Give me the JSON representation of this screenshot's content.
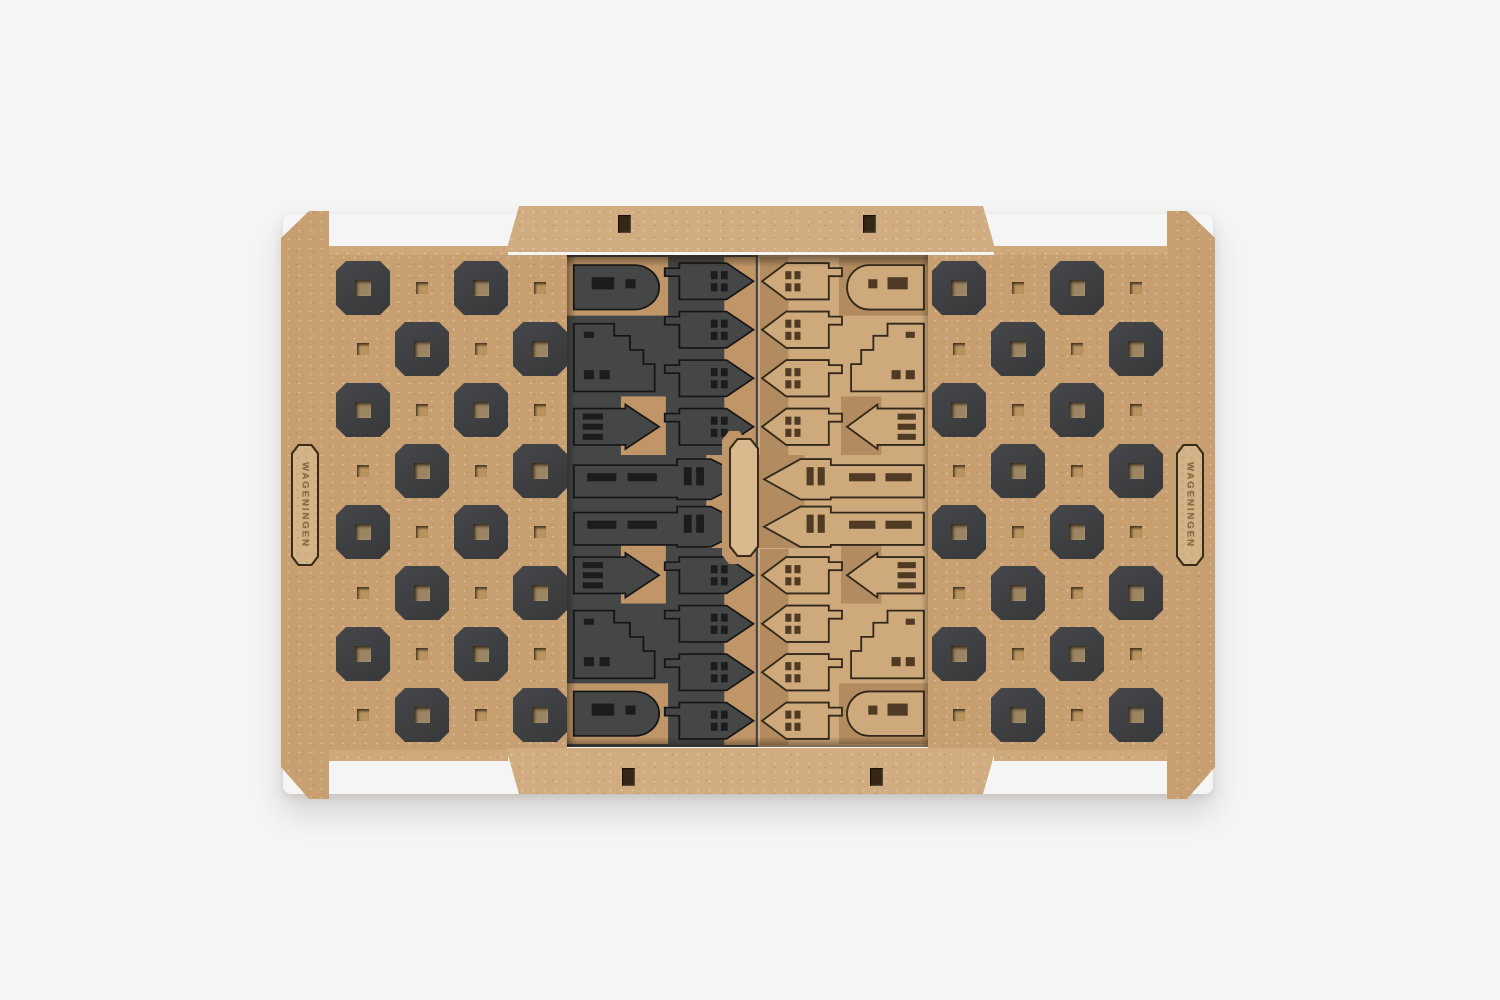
{
  "photo": {
    "background_color": "#f5f5f6",
    "engravings": {
      "left": "WAGENINGEN",
      "right": "WAGENINGEN"
    },
    "materials": {
      "wood_mid": "#c79f71",
      "wood_light": "#d0ac80",
      "wood_strip": "#cfa97b",
      "charcoal_square": "#3f4142",
      "dark_piece_sheet": "#454747",
      "light_piece_sheet": "#cda97c",
      "recess_tan": "#b28b60",
      "cutline_dark": "#141516",
      "cutline_brown": "#33281a"
    },
    "board": {
      "wing_grid": {
        "rows": 8,
        "cols": 4
      },
      "piece_inventory_per_color": {
        "pawn_houses": 8,
        "arch_roof_towers": 2,
        "stepped_gable_houses": 2,
        "spire_churches": 2,
        "large_churches": 2
      }
    }
  }
}
